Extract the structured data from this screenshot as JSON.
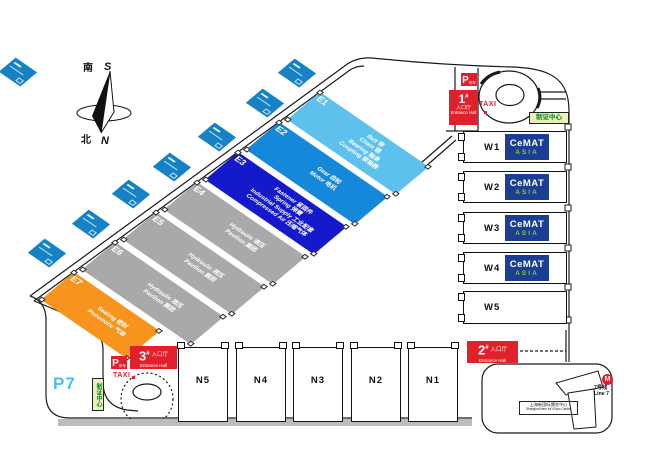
{
  "compass": {
    "south_cn": "南",
    "south_label": "S",
    "north_cn": "北",
    "north_label": "N"
  },
  "e_halls": [
    {
      "id": "E1",
      "color": "#5ec1ed",
      "lines": [
        "Belt 带",
        "Chain 链",
        "Bearing 轴承",
        "Coupling 联轴器"
      ]
    },
    {
      "id": "E2",
      "color": "#1688d9",
      "lines": [
        "Gear 齿轮",
        "Motor 电机"
      ]
    },
    {
      "id": "E3",
      "color": "#1419cb",
      "lines": [
        "Fastener 紧固件",
        "Spring 弹簧",
        "Industrial Supply 工业配套",
        "Compressed Air 压缩气体"
      ]
    },
    {
      "id": "E4",
      "color": "#a9a9ab",
      "lines": [
        "Hydraulic 液压",
        "Pavilion 展团"
      ]
    },
    {
      "id": "E5",
      "color": "#a9a9ab",
      "lines": [
        "Hydraulic 液压",
        "Pavilion 展团"
      ]
    },
    {
      "id": "E6",
      "color": "#a9a9ab",
      "lines": [
        "Hydraulic 液压",
        "Pavilion 展团"
      ]
    },
    {
      "id": "E7",
      "color": "#f7941d",
      "lines": [
        "Sealing 密封",
        "Pneumatic 气动"
      ]
    }
  ],
  "w_halls": [
    {
      "id": "W1",
      "cemat": true
    },
    {
      "id": "W2",
      "cemat": true
    },
    {
      "id": "W3",
      "cemat": true
    },
    {
      "id": "W4",
      "cemat": true
    },
    {
      "id": "W5",
      "cemat": false
    }
  ],
  "n_halls": [
    {
      "id": "N5"
    },
    {
      "id": "N4"
    },
    {
      "id": "N3"
    },
    {
      "id": "N2"
    },
    {
      "id": "N1"
    }
  ],
  "cemat_logo": {
    "top": "CeMAT",
    "bottom": "ASIA",
    "bg": "#1b3e93",
    "accent": "#8dc63f"
  },
  "entrances": [
    {
      "num": "1",
      "sup": "#",
      "cn": "入口厅",
      "en": "Entrance Hall"
    },
    {
      "num": "2",
      "sup": "#",
      "cn": "入口厅",
      "en": "Entrance Hall"
    },
    {
      "num": "3",
      "sup": "#",
      "cn": "入口厅",
      "en": "Entrance Hall"
    }
  ],
  "taxi_label": "TAXI",
  "parking": {
    "label": "P",
    "sub": "停车"
  },
  "p7_label": "P7",
  "credential_center_label": "制证中心",
  "metro": {
    "logo_letter": "M",
    "line_cn": "7号线",
    "line_en": "Line 7",
    "station_cn": "上海新国际博览中心",
    "station_en": "Shanghai New Int'l Expo Centre"
  }
}
